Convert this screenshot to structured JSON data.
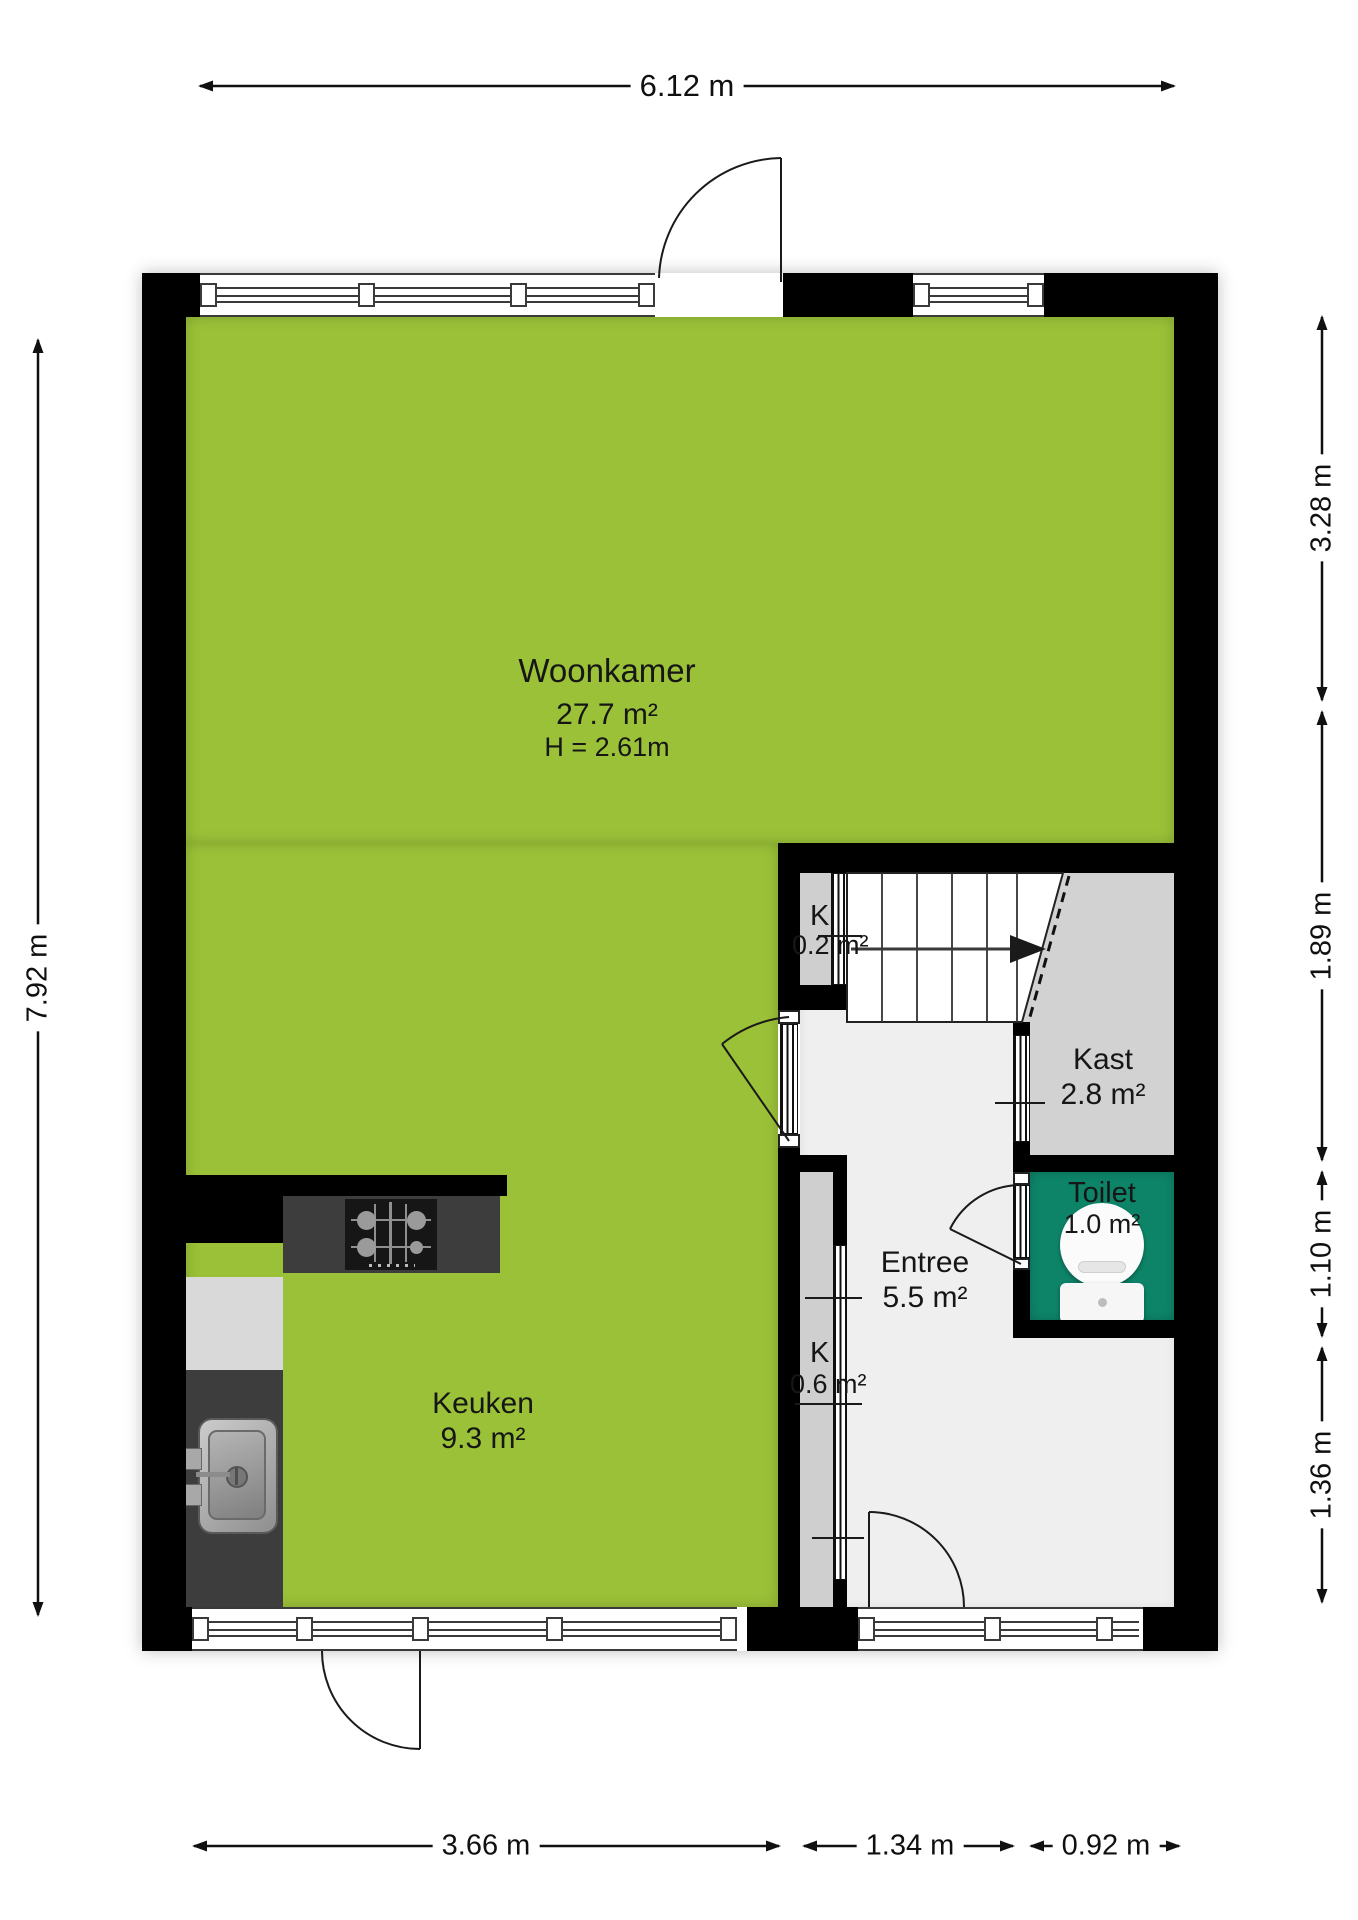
{
  "rooms": {
    "woonkamer": {
      "label": "Woonkamer",
      "area": "27.7 m²",
      "ceiling_height": "H = 2.61m"
    },
    "keuken": {
      "label": "Keuken",
      "area": "9.3 m²"
    },
    "entree": {
      "label": "Entree",
      "area": "5.5 m²"
    },
    "kast": {
      "label": "Kast",
      "area": "2.8 m²"
    },
    "toilet": {
      "label": "Toilet",
      "area": "1.0 m²"
    },
    "closet_stairs": {
      "label": "K",
      "area": "0.2 m²"
    },
    "closet_hall": {
      "label": "K",
      "area": "0.6 m²"
    }
  },
  "dimensions": {
    "top_width": "6.12 m",
    "left_height": "7.92 m",
    "right_segment_1": "3.28 m",
    "right_segment_2": "1.89 m",
    "right_segment_3": "1.10 m",
    "right_segment_4": "1.36 m",
    "bottom_segment_1": "3.66 m",
    "bottom_segment_2": "1.34 m",
    "bottom_segment_3": "0.92 m"
  },
  "colors": {
    "living_floor": "#9bc138",
    "toilet_floor": "#0d8468",
    "kast_floor": "#d2d2d2",
    "hall_floor": "#efefef",
    "closet_floor": "#cfcfcf",
    "wall": "#000000",
    "counter": "#3d3d3d",
    "appliance": "#d9d9d9"
  }
}
